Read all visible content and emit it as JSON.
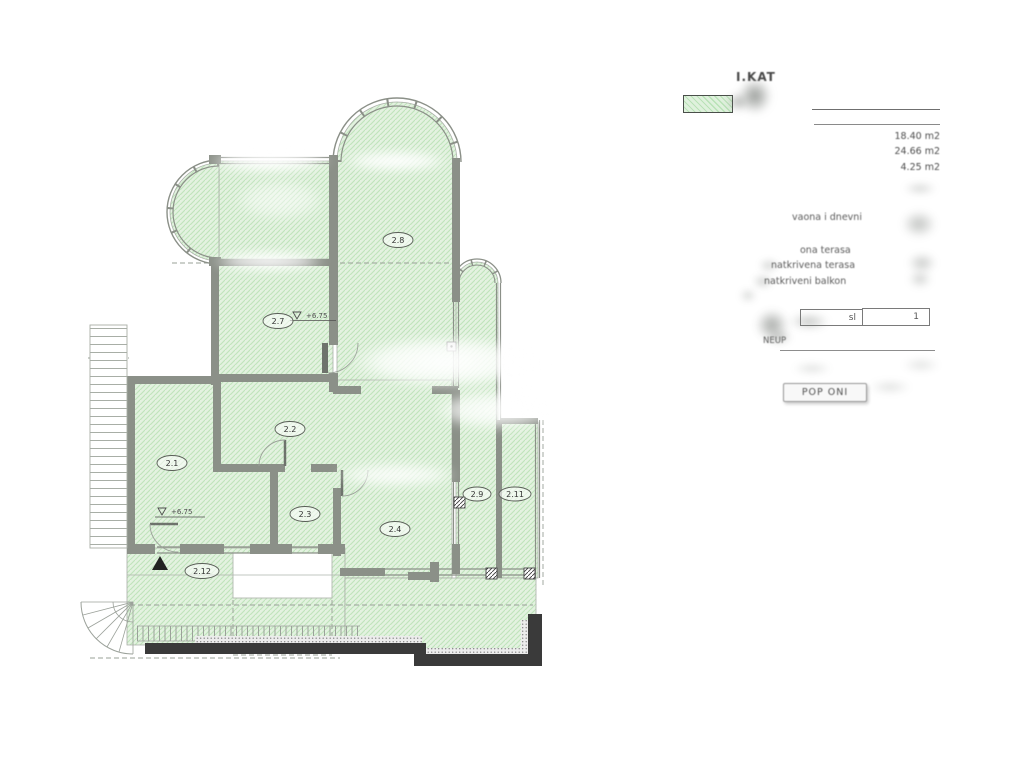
{
  "legend": {
    "title": "I.KAT",
    "areas": [
      "18.40 m2",
      "24.66 m2",
      "4.25 m2"
    ],
    "rows": [
      "vaona i dnevni",
      "ona terasa",
      "natkrivena terasa",
      "natkriveni balkon"
    ],
    "box_left_label": "sl",
    "box_right_label": "1",
    "neto_label": "NEUP",
    "button_label": "POP ONI"
  },
  "plan": {
    "room_labels": [
      "2.1",
      "2.2",
      "2.3",
      "2.4",
      "2.7",
      "2.8",
      "2.9",
      "2.11",
      "2.12"
    ],
    "level_markers": [
      "+6.75",
      "+6.75"
    ],
    "colors": {
      "hatch_fill": "#e3f2e0",
      "hatch_line": "#bfe3bb",
      "wall_gray": "#8b9088",
      "parapet_black": "#3a3a3a"
    }
  }
}
